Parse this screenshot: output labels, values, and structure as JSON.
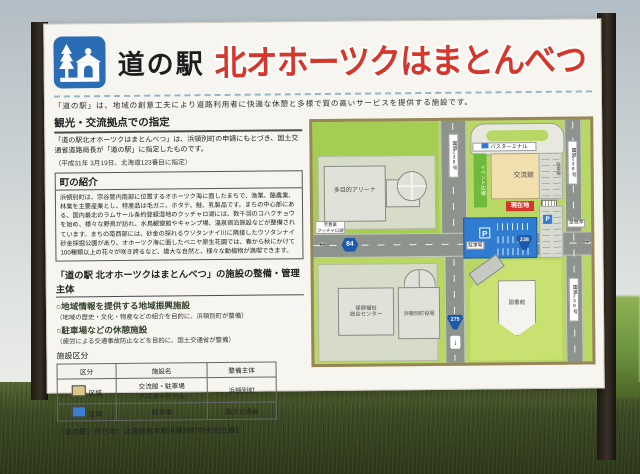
{
  "colors": {
    "accent_red": "#d6372b",
    "pictogram_blue": "#2a6db5",
    "parking_blue": "#2f7cd0",
    "zone_beige": "#d9c98e",
    "map_green": "#b9d765"
  },
  "header": {
    "station_label": "道の駅",
    "title": "北オホーツクはまとんべつ",
    "tagline": "「道の駅」は、地域の創意工夫により道路利用者に快適な休憩と多様で質の高いサービスを提供する施設です。"
  },
  "designation": {
    "heading": "観光・交流拠点での指定",
    "body": "「道の駅北オホーツクはまとんべつ」は、浜頓別町の申請にもとづき、国土交通省道路局長が「道の駅」に指定したものです。",
    "note": "（平成31年 3月19日、北海道123番目に指定）"
  },
  "town_intro": {
    "heading": "町の紹介",
    "body": "浜頓別町は、宗谷管内南部に位置するオホーツク海に面したまちで、漁業、酪農業、林業を主要産業とし、特産品は毛ガニ、ホタテ、鮭、乳製品です。まちの中心部にある、国内最北のラムサール条約登録湿地のクッチャロ湖には、数千羽のコハクチョウを始め、様々な野鳥が訪れ、水鳥観察館やキャンプ場、温泉宿泊施設などが整備されています。まちの南西部には、砂金の採れるウソタンナイ川に隣接したウソタンナイ砂金採掘公園があり、オホーツク海に面したベニヤ原生花園では、春から秋にかけて100種類以上の花々が咲き誇るなど、雄大な自然と、様々な動植物が満喫できます。"
  },
  "management": {
    "heading": "「道の駅 北オホーツクはまとんべつ」の施設の整備・管理主体",
    "items": [
      {
        "title": "○地域情報を提供する地域振興施設",
        "note": "（地域の歴史・文化・物産などの紹介を目的に、浜頓別町が整備）"
      },
      {
        "title": "○駐車場などの休憩施設",
        "note": "（疲労による交通事故防止などを目的に、国土交通省が整備）"
      }
    ]
  },
  "zoning_table": {
    "caption": "施設区分",
    "headers": [
      "区分",
      "施設名",
      "整備主体"
    ],
    "rows": [
      {
        "zone": "区域",
        "facility": "交流館・駐車場\nバスターミナル",
        "manager": "浜頓別町",
        "swatch_color": "#d9c98e"
      },
      {
        "zone": "区域",
        "facility": "駐車場",
        "manager": "国土交通省",
        "swatch_color": "#3b7fd4"
      }
    ]
  },
  "address": "「道の駅」所在地：北海道枝幸郡浜頓別町中央北21番1",
  "map": {
    "bus_terminal": "バスターミナル",
    "exchange_hall": "交流館",
    "current_location": "現在地",
    "event_plaza": "イベント広場",
    "arena": "多目的アリーナ",
    "parking": "駐車場",
    "parking_icon": "P",
    "health_center": "保健福祉\n総合センター",
    "town_hall": "浜頓別町役場",
    "library": "図書館",
    "route_84": "84",
    "route_238": "238",
    "route_275": "275",
    "road_238_label": "国道238号",
    "to_west": "至豊富\nクッチャロ湖",
    "to_east": "至枝幸",
    "to_south": "至音威子府",
    "arrow_left": "←",
    "arrow_right": "→",
    "arrow_down": "↓"
  }
}
